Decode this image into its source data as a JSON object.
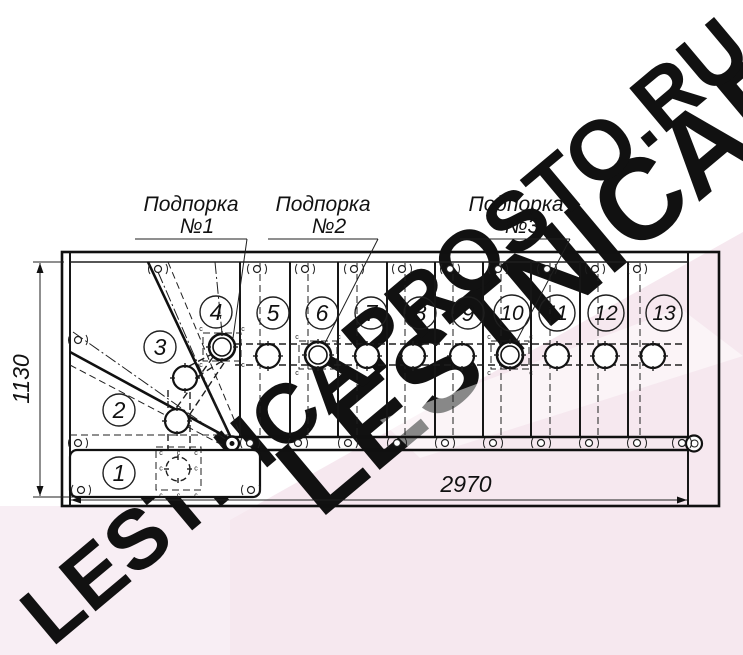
{
  "watermark": {
    "text": "LESTNICAPROSTO.RU"
  },
  "colors": {
    "line": "#1a1a1a",
    "pink_light": "#f8eef4",
    "pink_mid": "#f6e8ef",
    "watermark_grey": "#ececec",
    "watermark_pink": "#f3dce9"
  },
  "labels": {
    "support_word": "Подпорка",
    "supports": [
      {
        "number": "№1"
      },
      {
        "number": "№2"
      },
      {
        "number": "№3"
      }
    ]
  },
  "dimensions": {
    "width": "2970",
    "height": "1130"
  },
  "steps": [
    {
      "label": "1"
    },
    {
      "label": "2"
    },
    {
      "label": "3"
    },
    {
      "label": "4"
    },
    {
      "label": "5"
    },
    {
      "label": "6"
    },
    {
      "label": "7"
    },
    {
      "label": "8"
    },
    {
      "label": "9"
    },
    {
      "label": "10"
    },
    {
      "label": "11"
    },
    {
      "label": "12"
    },
    {
      "label": "13"
    }
  ],
  "drawing": {
    "c_mark": "c",
    "fasteners": [
      [
        158,
        269
      ],
      [
        257,
        269
      ],
      [
        305,
        269
      ],
      [
        354,
        269
      ],
      [
        402,
        269
      ],
      [
        450,
        269
      ],
      [
        498,
        269
      ],
      [
        547,
        269
      ],
      [
        595,
        269
      ],
      [
        637,
        269
      ],
      [
        250,
        443
      ],
      [
        298,
        443
      ],
      [
        348,
        443
      ],
      [
        397,
        443
      ],
      [
        445,
        443
      ],
      [
        493,
        443
      ],
      [
        541,
        443
      ],
      [
        589,
        443
      ],
      [
        637,
        443
      ],
      [
        682,
        443
      ],
      [
        78,
        340
      ],
      [
        78,
        443
      ],
      [
        81,
        490
      ],
      [
        251,
        490
      ]
    ],
    "posts_plain": [
      [
        268,
        356
      ],
      [
        367,
        356
      ],
      [
        413,
        356
      ],
      [
        462,
        356
      ],
      [
        557,
        356
      ],
      [
        605,
        356
      ],
      [
        653,
        356
      ],
      [
        185,
        378
      ],
      [
        177,
        421
      ]
    ],
    "posts_support": [
      [
        222,
        347
      ],
      [
        318,
        355
      ],
      [
        510,
        355
      ]
    ],
    "posts_dashed": [
      [
        178,
        469
      ]
    ],
    "dashed_boxes": [
      {
        "x": 156,
        "y": 447,
        "w": 45,
        "h": 43
      }
    ]
  }
}
